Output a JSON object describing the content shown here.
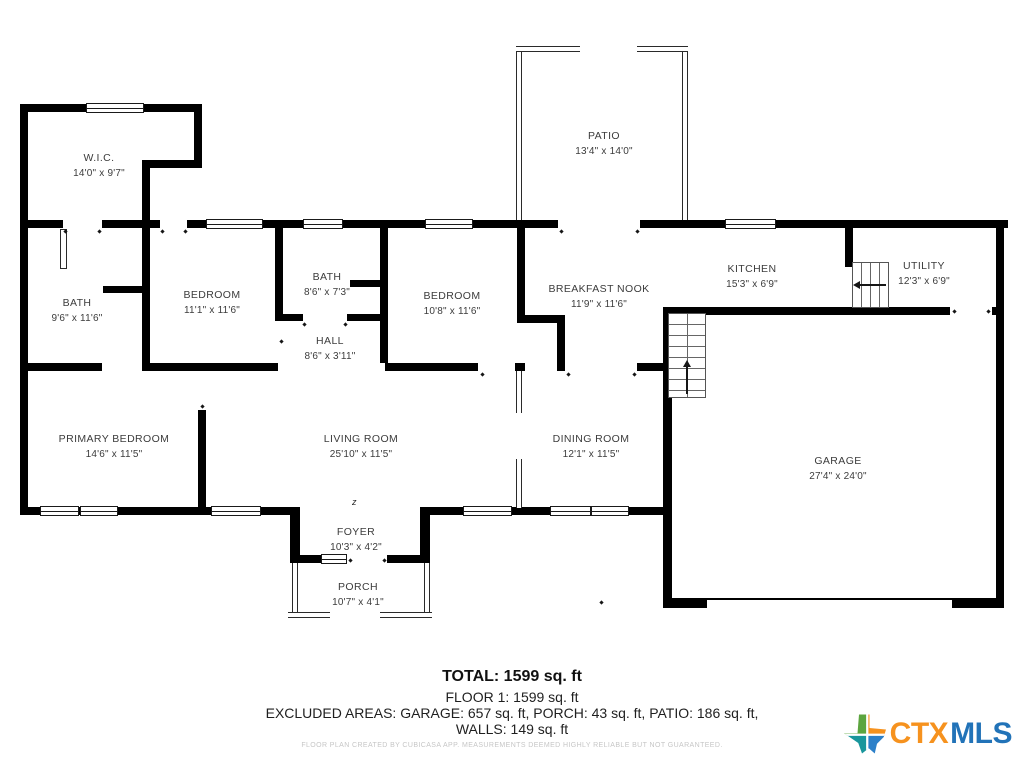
{
  "rooms": {
    "wic": {
      "name": "W.I.C.",
      "dims": "14'0\" x 9'7\""
    },
    "patio": {
      "name": "PATIO",
      "dims": "13'4\" x 14'0\""
    },
    "bath1": {
      "name": "BATH",
      "dims": "9'6\" x 11'6\""
    },
    "bedroom1": {
      "name": "BEDROOM",
      "dims": "11'1\" x 11'6\""
    },
    "bath2": {
      "name": "BATH",
      "dims": "8'6\" x 7'3\""
    },
    "bedroom2": {
      "name": "BEDROOM",
      "dims": "10'8\" x 11'6\""
    },
    "nook": {
      "name": "BREAKFAST NOOK",
      "dims": "11'9\" x 11'6\""
    },
    "kitchen": {
      "name": "KITCHEN",
      "dims": "15'3\" x 6'9\""
    },
    "utility": {
      "name": "UTILITY",
      "dims": "12'3\" x 6'9\""
    },
    "hall": {
      "name": "HALL",
      "dims": "8'6\" x 3'11\""
    },
    "primary": {
      "name": "PRIMARY BEDROOM",
      "dims": "14'6\" x 11'5\""
    },
    "living": {
      "name": "LIVING ROOM",
      "dims": "25'10\" x 11'5\""
    },
    "dining": {
      "name": "DINING ROOM",
      "dims": "12'1\" x 11'5\""
    },
    "garage": {
      "name": "GARAGE",
      "dims": "27'4\" x 24'0\""
    },
    "foyer": {
      "name": "FOYER",
      "dims": "10'3\" x 4'2\""
    },
    "porch": {
      "name": "PORCH",
      "dims": "10'7\" x 4'1\""
    }
  },
  "summary": {
    "total": "TOTAL: 1599 sq. ft",
    "floor": "FLOOR 1: 1599 sq. ft",
    "excluded": "EXCLUDED AREAS: GARAGE: 657 sq. ft, PORCH: 43 sq. ft, PATIO: 186 sq. ft,",
    "walls": "WALLS: 149 sq. ft"
  },
  "disclaimer": "FLOOR PLAN CREATED BY CUBICASA APP. MEASUREMENTS DEEMED HIGHLY RELIABLE BUT NOT GUARANTEED.",
  "annotations": {
    "north_mark": "z"
  },
  "logo": {
    "ctx": "CTX",
    "mls": "MLS",
    "ctx_color": "#F6921E",
    "mls_color": "#2273B8",
    "icon_colors": {
      "green": "#5CA53F",
      "orange": "#F6921E",
      "teal": "#19969C",
      "blue": "#2C80C9"
    }
  }
}
